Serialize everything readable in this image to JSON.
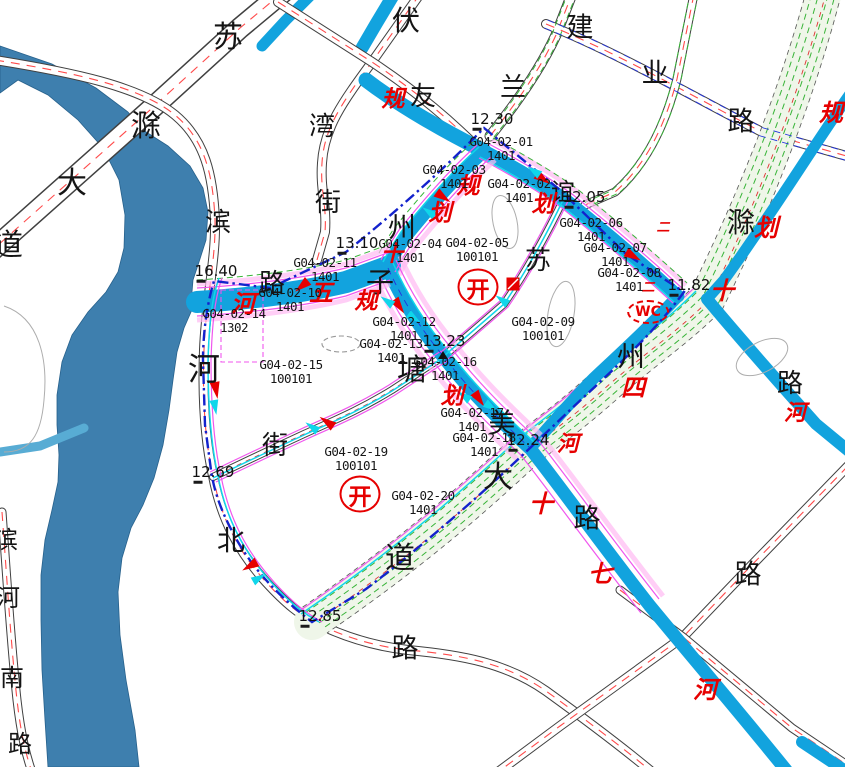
{
  "map": {
    "colors": {
      "river": "#3E7FAE",
      "branch": "#58ACD4",
      "canal": "#12A3DE",
      "corridor": "#EFF6E9",
      "green": "#38B438",
      "magenta": "#F056EE",
      "pink": "#FFB9F2",
      "cyan": "#10D6EA",
      "boundary": "#1322CC",
      "red": "#E60000",
      "roadRed": "#FF4A4A",
      "casing": "#404040"
    },
    "street_labels": [
      {
        "t": "苏",
        "x": 228,
        "y": 38,
        "s": 30
      },
      {
        "t": "滁",
        "x": 146,
        "y": 127,
        "s": 30
      },
      {
        "t": "大",
        "x": 72,
        "y": 184,
        "s": 30
      },
      {
        "t": "道",
        "x": 8,
        "y": 246,
        "s": 30
      },
      {
        "t": "伏",
        "x": 406,
        "y": 21,
        "s": 28
      },
      {
        "t": "友",
        "x": 423,
        "y": 97,
        "s": 26
      },
      {
        "t": "兰",
        "x": 513,
        "y": 88,
        "s": 26
      },
      {
        "t": "湾",
        "x": 322,
        "y": 127,
        "s": 26
      },
      {
        "t": "街",
        "x": 328,
        "y": 203,
        "s": 26
      },
      {
        "t": "建",
        "x": 580,
        "y": 28,
        "s": 27
      },
      {
        "t": "业",
        "x": 655,
        "y": 74,
        "s": 27
      },
      {
        "t": "路",
        "x": 741,
        "y": 122,
        "s": 27
      },
      {
        "t": "州",
        "x": 402,
        "y": 228,
        "s": 28
      },
      {
        "t": "子",
        "x": 380,
        "y": 283,
        "s": 28
      },
      {
        "t": "路",
        "x": 272,
        "y": 284,
        "s": 26
      },
      {
        "t": "塘",
        "x": 412,
        "y": 371,
        "s": 30
      },
      {
        "t": "街",
        "x": 275,
        "y": 446,
        "s": 26
      },
      {
        "t": "北",
        "x": 231,
        "y": 541,
        "s": 28
      },
      {
        "t": "河",
        "x": 204,
        "y": 369,
        "s": 32
      },
      {
        "t": "滨",
        "x": 218,
        "y": 223,
        "s": 26
      },
      {
        "t": "苏",
        "x": 538,
        "y": 261,
        "s": 26
      },
      {
        "t": "谊",
        "x": 563,
        "y": 192,
        "s": 24
      },
      {
        "t": "滁",
        "x": 741,
        "y": 223,
        "s": 28
      },
      {
        "t": "州",
        "x": 631,
        "y": 357,
        "s": 28
      },
      {
        "t": "大",
        "x": 498,
        "y": 478,
        "s": 30
      },
      {
        "t": "道",
        "x": 400,
        "y": 559,
        "s": 30
      },
      {
        "t": "美",
        "x": 502,
        "y": 424,
        "s": 27
      },
      {
        "t": "路",
        "x": 587,
        "y": 519,
        "s": 27
      },
      {
        "t": "路",
        "x": 748,
        "y": 575,
        "s": 27
      },
      {
        "t": "路",
        "x": 790,
        "y": 384,
        "s": 26
      },
      {
        "t": "路",
        "x": 405,
        "y": 649,
        "s": 27
      },
      {
        "t": "滨",
        "x": 6,
        "y": 540,
        "s": 24
      },
      {
        "t": "河",
        "x": 8,
        "y": 598,
        "s": 24
      },
      {
        "t": "南",
        "x": 12,
        "y": 678,
        "s": 24
      },
      {
        "t": "路",
        "x": 20,
        "y": 744,
        "s": 24
      }
    ],
    "planning_labels": [
      {
        "t": "规",
        "x": 393,
        "y": 100,
        "s": 23
      },
      {
        "t": "划",
        "x": 440,
        "y": 214,
        "s": 23
      },
      {
        "t": "规",
        "x": 468,
        "y": 187,
        "s": 23
      },
      {
        "t": "划",
        "x": 543,
        "y": 205,
        "s": 23
      },
      {
        "t": "规",
        "x": 366,
        "y": 302,
        "s": 23
      },
      {
        "t": "划",
        "x": 452,
        "y": 397,
        "s": 23
      },
      {
        "t": "五",
        "x": 321,
        "y": 293,
        "s": 24
      },
      {
        "t": "河",
        "x": 243,
        "y": 304,
        "s": 24
      },
      {
        "t": "十",
        "x": 392,
        "y": 255,
        "s": 22
      },
      {
        "t": "规",
        "x": 831,
        "y": 113,
        "s": 24
      },
      {
        "t": "划",
        "x": 766,
        "y": 228,
        "s": 24
      },
      {
        "t": "十",
        "x": 722,
        "y": 291,
        "s": 24
      },
      {
        "t": "四",
        "x": 633,
        "y": 388,
        "s": 24
      },
      {
        "t": "河",
        "x": 568,
        "y": 445,
        "s": 22
      },
      {
        "t": "十",
        "x": 541,
        "y": 504,
        "s": 24
      },
      {
        "t": "七",
        "x": 600,
        "y": 574,
        "s": 24
      },
      {
        "t": "河",
        "x": 705,
        "y": 690,
        "s": 24
      },
      {
        "t": "河",
        "x": 795,
        "y": 414,
        "s": 22
      },
      {
        "t": "二",
        "x": 663,
        "y": 228,
        "s": 13
      },
      {
        "t": "二",
        "x": 648,
        "y": 288,
        "s": 13
      }
    ],
    "parcel_labels": [
      {
        "code": "G04-02-01",
        "use": "1401",
        "x": 501,
        "y": 149
      },
      {
        "code": "G04-02-02",
        "use": "1401",
        "x": 519,
        "y": 191
      },
      {
        "code": "G04-02-03",
        "use": "1401",
        "x": 454,
        "y": 177
      },
      {
        "code": "G04-02-04",
        "use": "1401",
        "x": 410,
        "y": 251
      },
      {
        "code": "G04-02-05",
        "use": "100101",
        "x": 477,
        "y": 250
      },
      {
        "code": "G04-02-06",
        "use": "1401",
        "x": 591,
        "y": 230
      },
      {
        "code": "G04-02-07",
        "use": "1401",
        "x": 615,
        "y": 255
      },
      {
        "code": "G04-02-08",
        "use": "1401",
        "x": 629,
        "y": 280
      },
      {
        "code": "G04-02-09",
        "use": "100101",
        "x": 543,
        "y": 329
      },
      {
        "code": "G04-02-10",
        "use": "1401",
        "x": 290,
        "y": 300
      },
      {
        "code": "G04-02-11",
        "use": "1401",
        "x": 325,
        "y": 270
      },
      {
        "code": "G04-02-12",
        "use": "1401",
        "x": 404,
        "y": 329
      },
      {
        "code": "G04-02-13",
        "use": "1401",
        "x": 391,
        "y": 351
      },
      {
        "code": "G04-02-14",
        "use": "1302",
        "x": 234,
        "y": 321
      },
      {
        "code": "G04-02-15",
        "use": "100101",
        "x": 291,
        "y": 372
      },
      {
        "code": "G04-02-16",
        "use": "1401",
        "x": 445,
        "y": 369
      },
      {
        "code": "G04-02-17",
        "use": "1401",
        "x": 472,
        "y": 420
      },
      {
        "code": "G04-02-18",
        "use": "1401",
        "x": 484,
        "y": 445
      },
      {
        "code": "G04-02-19",
        "use": "100101",
        "x": 356,
        "y": 459
      },
      {
        "code": "G04-02-20",
        "use": "1401",
        "x": 423,
        "y": 503
      }
    ],
    "elevation_labels": [
      {
        "v": "12.30",
        "x": 492,
        "y": 121
      },
      {
        "v": "12.05",
        "x": 584,
        "y": 199
      },
      {
        "v": "13.10",
        "x": 357,
        "y": 245
      },
      {
        "v": "16.40",
        "x": 216,
        "y": 273
      },
      {
        "v": "11.82",
        "x": 689,
        "y": 287
      },
      {
        "v": "13.23",
        "x": 444,
        "y": 343
      },
      {
        "v": "12.24",
        "x": 528,
        "y": 442
      },
      {
        "v": "12.69",
        "x": 213,
        "y": 474
      },
      {
        "v": "12.85",
        "x": 320,
        "y": 618
      }
    ],
    "seals": [
      {
        "t": "开",
        "x": 478,
        "y": 287
      },
      {
        "t": "开",
        "x": 360,
        "y": 494
      }
    ],
    "wc": {
      "t": "WC",
      "x": 648,
      "y": 312
    },
    "markers": {
      "red_triangles": [
        {
          "x": 443,
          "y": 197,
          "r": 35
        },
        {
          "x": 543,
          "y": 179,
          "r": 35
        },
        {
          "x": 633,
          "y": 256,
          "r": 30
        },
        {
          "x": 302,
          "y": 286,
          "r": 140
        },
        {
          "x": 399,
          "y": 306,
          "r": 55
        },
        {
          "x": 479,
          "y": 399,
          "r": 55
        },
        {
          "x": 216,
          "y": 390,
          "r": 80
        },
        {
          "x": 327,
          "y": 422,
          "r": 215
        },
        {
          "x": 250,
          "y": 566,
          "r": 150
        }
      ],
      "red_squares": [
        {
          "x": 513,
          "y": 284,
          "r": 0
        }
      ],
      "cyan_triangles": [
        {
          "x": 429,
          "y": 212,
          "r": 215
        },
        {
          "x": 534,
          "y": 171,
          "r": 215
        },
        {
          "x": 502,
          "y": 300,
          "r": 215
        },
        {
          "x": 387,
          "y": 301,
          "r": 215
        },
        {
          "x": 414,
          "y": 318,
          "r": 35
        },
        {
          "x": 464,
          "y": 396,
          "r": 215
        },
        {
          "x": 491,
          "y": 407,
          "r": 35
        },
        {
          "x": 215,
          "y": 407,
          "r": 80
        },
        {
          "x": 312,
          "y": 427,
          "r": 215
        },
        {
          "x": 259,
          "y": 578,
          "r": 330
        }
      ],
      "black_triangles": [
        {
          "x": 443,
          "y": 355,
          "r": 180
        }
      ]
    }
  }
}
